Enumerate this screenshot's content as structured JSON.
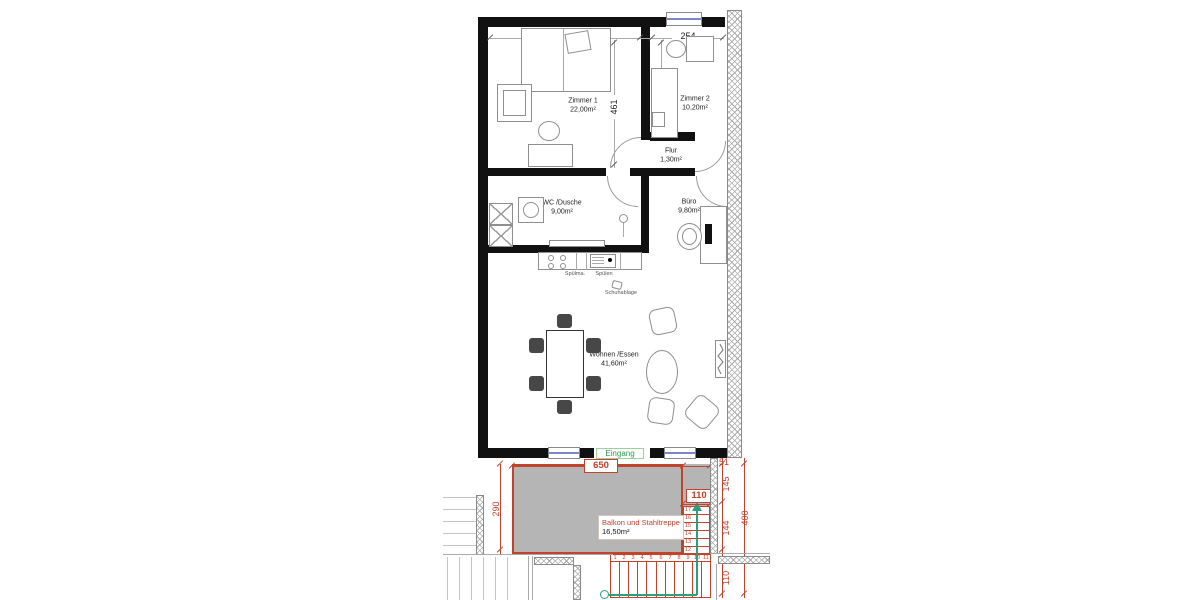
{
  "rooms": {
    "zimmer1": {
      "name": "Zimmer 1",
      "area": "22,00m²"
    },
    "zimmer2": {
      "name": "Zimmer 2",
      "area": "10,20m²"
    },
    "flur": {
      "name": "Flur",
      "area": "1,30m²"
    },
    "wc": {
      "name": "WC /Dusche",
      "area": "9,00m²"
    },
    "buero": {
      "name": "Büro",
      "area": "9,80m²"
    },
    "wohnen": {
      "name": "Wohnen /Essen",
      "area": "41,60m²"
    },
    "balkon": {
      "name": "Balkon und Stahltreppe",
      "area": "16,50m²"
    }
  },
  "dims": {
    "top_left": "484",
    "top_right": "254",
    "z1_height": "461",
    "z2_height": "349",
    "balkon_width": "650",
    "balkon_depth": "290",
    "stair_width_top": "110",
    "right_gap": "51",
    "right_upper": "145",
    "right_mid": "144",
    "right_total": "400",
    "right_lower": "110"
  },
  "labels": {
    "entrance": "Eingang",
    "kitchen_left": "Spülma.",
    "kitchen_right": "Spülen",
    "shoe": "Schuhablage"
  },
  "stairs": {
    "run": [
      "1",
      "2",
      "3",
      "4",
      "5",
      "6",
      "7",
      "8",
      "9",
      "10",
      "11"
    ],
    "flight": [
      "17",
      "16",
      "15",
      "14",
      "13",
      "12"
    ]
  },
  "colors": {
    "wall": "#111111",
    "dim_red": "#c0432c",
    "balcony_fill": "#b5b5b5",
    "entrance_green": "#2e9c52",
    "stair_green": "#2aa07e",
    "window_blue": "#7b87c9"
  }
}
